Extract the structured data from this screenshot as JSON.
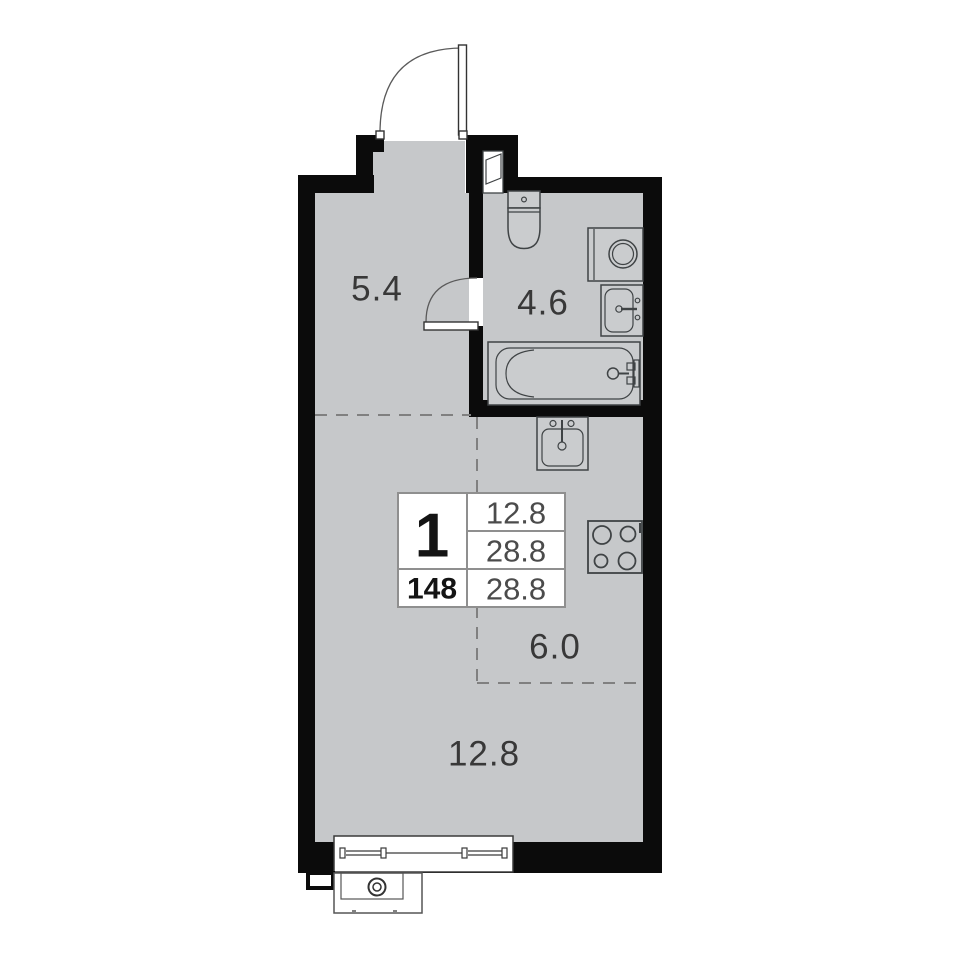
{
  "title": "Studio apartment floor plan",
  "info_card": {
    "rooms_count": "1",
    "apartment_number": "148",
    "row1_area": "12.8",
    "row2_area": "28.8",
    "row3_area": "28.8"
  },
  "rooms": {
    "hallway": {
      "area": "5.4"
    },
    "bathroom": {
      "area": "4.6"
    },
    "kitchen": {
      "area": "6.0"
    },
    "living": {
      "area": "12.8"
    }
  },
  "fixtures": [
    "entrance-door",
    "vent-shaft",
    "toilet",
    "washing-machine",
    "bathroom-sink",
    "bathtub",
    "bathroom-door",
    "kitchen-sink",
    "stove",
    "window",
    "ac-unit-basket"
  ],
  "colors": {
    "wall": "#0b0b0b",
    "floor": "#c6c8ca",
    "background": "#ffffff",
    "fixture_outline": "#3f4345",
    "dashed_divider": "#808080",
    "table_border": "#8f8f8f",
    "text_dark": "#141414",
    "text_gray": "#4b4b4b",
    "room_label": "#383838"
  }
}
